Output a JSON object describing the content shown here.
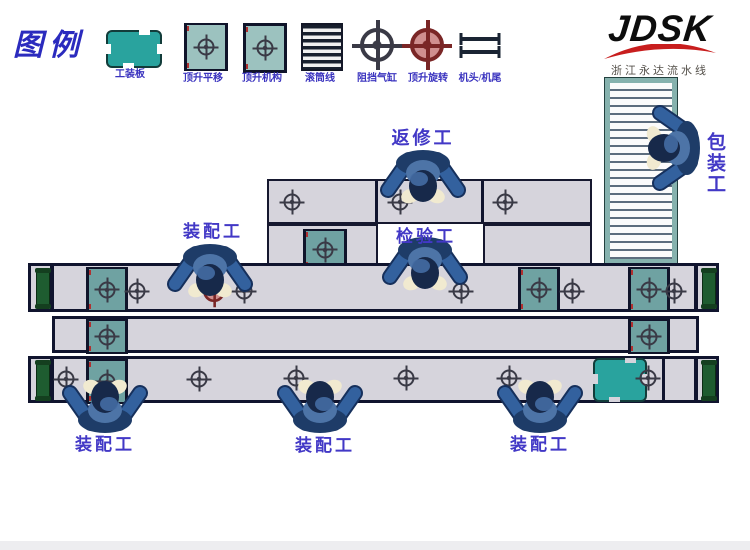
{
  "legend": {
    "title": "图例",
    "items": [
      {
        "name": "pallet",
        "label": "工装板"
      },
      {
        "name": "lift-translate",
        "label": "顶升平移"
      },
      {
        "name": "lift-mechanism",
        "label": "顶升机构"
      },
      {
        "name": "roller-line",
        "label": "滚筒线"
      },
      {
        "name": "stop-cylinder",
        "label": "阻挡气缸"
      },
      {
        "name": "lift-rotate",
        "label": "顶升旋转"
      },
      {
        "name": "head-tail",
        "label": "机头/机尾"
      }
    ]
  },
  "logo": {
    "brand": "JDSK",
    "tagline": "浙江永达流水线"
  },
  "workers": {
    "rework": {
      "label": "返修工"
    },
    "inspection": {
      "label": "检验工"
    },
    "assembly_top": {
      "label": "装配工"
    },
    "packing": {
      "label": "包装工"
    },
    "assembly_bottom_1": {
      "label": "装配工"
    },
    "assembly_bottom_2": {
      "label": "装配工"
    },
    "assembly_bottom_3": {
      "label": "装配工"
    }
  },
  "colors": {
    "label_blue": "#4238c6",
    "legend_blue": "#3a33bf",
    "line_fill": "#d6d4dc",
    "line_border": "#10142e",
    "mechanism_teal": "#6fa2a2",
    "plate_teal": "#29a39e",
    "end_roller_green": "#1e5c30",
    "rotary_pink": "#d08f8f",
    "logo_red": "#c81e1e",
    "conveyor_frame_teal": "#86b2ae"
  }
}
